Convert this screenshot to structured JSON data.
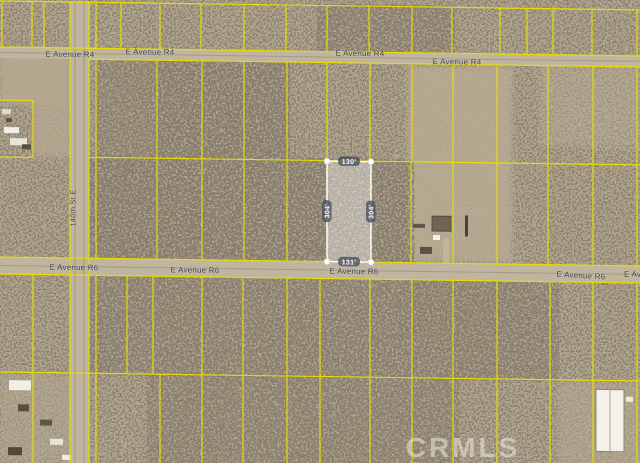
{
  "map": {
    "terrain": {
      "ground_color": "#b1a58d",
      "bush_color": "#42382b",
      "road_color": "#c0b59e",
      "parcel_line_color": "#e8df00"
    },
    "roads": {
      "r4": {
        "label": "E Avenue R4"
      },
      "r6": {
        "label": "E Avenue R6"
      },
      "street140": {
        "label": "140th St E"
      }
    },
    "subject_parcel": {
      "dim_top": "130'",
      "dim_bottom": "131'",
      "dim_left": "304'",
      "dim_right": "304'",
      "fill": "rgba(255,255,255,0.38)",
      "border_color": "#ffffff",
      "dim_bg": "rgba(72,78,95,0.78)",
      "dim_text_color": "#ffffff"
    },
    "watermark": {
      "text": "CRMLS",
      "color": "rgba(243,242,238,0.5)"
    }
  }
}
